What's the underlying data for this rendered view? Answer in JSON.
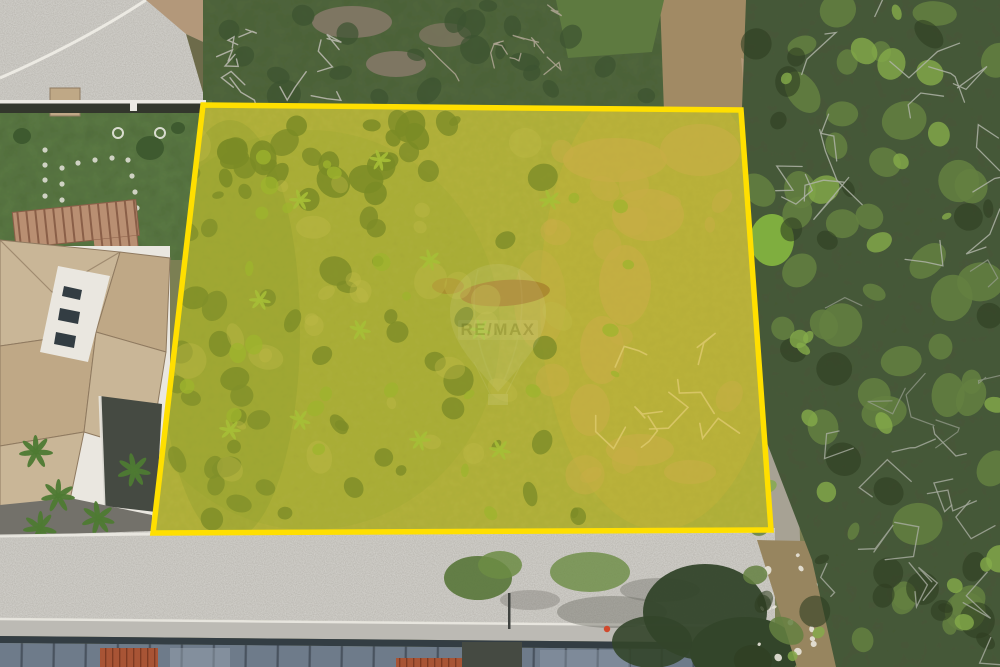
{
  "image": {
    "width": 1000,
    "height": 667,
    "alt": "Aerial drone photograph of a vacant land plot outlined and shaded in yellow, bordered by a house with tan tile roofs on the left, a walled garden and curved street at the top left, dense scrub forest on the right, and a cobblestone street with rooftops at the bottom"
  },
  "watermark": {
    "brand": "RE/MAX",
    "opacity": 0.16
  },
  "plot": {
    "points": "203,105 741,110 771,530 153,533",
    "fill": "#ffe400",
    "fill_opacity": 0.27,
    "stroke": "#ffdf00",
    "stroke_width": 5.5
  },
  "colors": {
    "base": "#7b7f53",
    "pavement": "#b6b3ac",
    "curb": "#eceae3",
    "dirtTan": "#b3987a",
    "dirtTan2": "#a18a64",
    "dirtGray": "#7e7662",
    "scrubBrown": "#6d6b4a",
    "lawn": "#5c7a44",
    "treeDark": "#3e5a2f",
    "pergola": "#b98f72",
    "pergolaSlat": "#8a5f48",
    "roofTan": "#c9b697",
    "roofTan2": "#bfa886",
    "roofEdge": "#8f7a60",
    "wallWhite": "#eae7e0",
    "windowDark": "#333d43",
    "shadowDark": "#454a42",
    "driveway": "#73716a",
    "wallDark": "#33372c",
    "brush": "#51663c",
    "grassTop": "#5e7a40",
    "forest": "#47573a",
    "bushBright": "#7fae3f",
    "plotGrass": "#96a052",
    "dirtCol": "#b29a5e",
    "brownDirt": "#8a6240",
    "shadeGreen": "#6f8f3f",
    "shadeGold": "#c2a44e",
    "leftBandGreen": "#5d7f3a",
    "canopyRoad": "#587539",
    "canopyRoad2": "#6c8c44",
    "canopyDarkRoad": "#33452a",
    "roadShadow": "#6f6e66",
    "sidewalk": "#bcbab4",
    "panelBase": "#6e7b8a",
    "panelLine": "#49535f",
    "panelLight": "#97a3b0",
    "tileRed": "#a85435",
    "tileRedDark": "#7e3a22",
    "pathGray": "#a7a294",
    "trailDirt": "#97855f",
    "personRed": "#d0492c",
    "poleDark": "#3f423f"
  },
  "texture": {
    "seed": 11,
    "specs": [
      {
        "type": "blob",
        "name": "plot-bush-dark",
        "layer": "interior",
        "region": [
          175,
          120,
          610,
          520
        ],
        "count": 46,
        "rmin": 5,
        "rmax": 15,
        "color": "#4d6c36",
        "opacity": 0.8
      },
      {
        "type": "blob",
        "name": "plot-bush-row-top",
        "layer": "interior",
        "region": [
          205,
          115,
          430,
          200
        ],
        "count": 18,
        "rmin": 8,
        "rmax": 18,
        "color": "#4a6a34",
        "opacity": 0.85
      },
      {
        "type": "blob",
        "name": "plot-bush-left",
        "layer": "interior",
        "region": [
          170,
          150,
          280,
          520
        ],
        "count": 20,
        "rmin": 8,
        "rmax": 16,
        "color": "#527139",
        "opacity": 0.8
      },
      {
        "type": "blob",
        "name": "plot-dry-grass",
        "layer": "interior",
        "region": [
          545,
          130,
          735,
          500
        ],
        "count": 16,
        "rmin": 8,
        "rmax": 20,
        "color": "#b49a5f",
        "opacity": 0.5
      },
      {
        "type": "blob",
        "name": "plot-grass-light",
        "layer": "interior",
        "region": [
          175,
          140,
          600,
          520
        ],
        "count": 30,
        "rmin": 6,
        "rmax": 18,
        "color": "#a8ab62",
        "opacity": 0.4
      },
      {
        "type": "blob",
        "name": "plot-bush-bright",
        "layer": "interior",
        "region": [
          185,
          130,
          630,
          515
        ],
        "count": 26,
        "rmin": 4,
        "rmax": 9,
        "color": "#7ba33e",
        "opacity": 0.75
      },
      {
        "type": "palm",
        "name": "plot-palm",
        "layer": "interior",
        "centers": [
          [
            300,
            200
          ],
          [
            260,
            300
          ],
          [
            360,
            330
          ],
          [
            300,
            420
          ],
          [
            430,
            260
          ],
          [
            480,
            330
          ],
          [
            420,
            440
          ],
          [
            500,
            450
          ],
          [
            380,
            160
          ],
          [
            550,
            200
          ],
          [
            230,
            430
          ]
        ],
        "petals": 6,
        "len": 11,
        "color": "#86b04a",
        "opacity": 0.9
      },
      {
        "type": "branch",
        "name": "fallen-tree-branch",
        "layer": "interior",
        "region": [
          600,
          345,
          715,
          445
        ],
        "count": 8,
        "len": 22,
        "color": "#cdbd8f",
        "width": 1.6,
        "opacity": 0.9
      },
      {
        "type": "blob",
        "name": "forest-canopy",
        "layer": "forest",
        "region": [
          752,
          0,
          1000,
          667
        ],
        "count": 46,
        "rmin": 9,
        "rmax": 24,
        "color": "#648041",
        "opacity": 0.85
      },
      {
        "type": "blob",
        "name": "forest-canopy-dark",
        "layer": "forest",
        "region": [
          752,
          0,
          1000,
          667
        ],
        "count": 28,
        "rmin": 7,
        "rmax": 18,
        "color": "#2e3d22",
        "opacity": 0.6
      },
      {
        "type": "blob",
        "name": "forest-canopy-bright",
        "layer": "forest",
        "region": [
          760,
          0,
          1000,
          667
        ],
        "count": 24,
        "rmin": 5,
        "rmax": 14,
        "color": "#85ab4a",
        "opacity": 0.8
      },
      {
        "type": "branch",
        "name": "forest-bare-branch",
        "layer": "forest",
        "region": [
          795,
          10,
          1000,
          250
        ],
        "count": 16,
        "len": 30,
        "color": "#aeb3a6",
        "width": 1.3,
        "opacity": 0.85
      },
      {
        "type": "branch",
        "name": "forest-bare-branch-low",
        "layer": "forest",
        "region": [
          820,
          420,
          1000,
          660
        ],
        "count": 14,
        "len": 30,
        "color": "#a9aea1",
        "width": 1.3,
        "opacity": 0.8
      },
      {
        "type": "branch",
        "name": "forest-bare-branch-mid",
        "layer": "forest",
        "region": [
          860,
          260,
          1000,
          430
        ],
        "count": 6,
        "len": 26,
        "color": "#9aa092",
        "width": 1.2,
        "opacity": 0.7
      },
      {
        "type": "blob",
        "name": "top-brush",
        "layer": "topstrip",
        "region": [
          210,
          5,
          650,
          100
        ],
        "count": 22,
        "rmin": 6,
        "rmax": 16,
        "color": "#3c5330",
        "opacity": 0.7
      },
      {
        "type": "branch",
        "name": "top-dead-branch",
        "layer": "topstrip",
        "region": [
          225,
          35,
          340,
          98
        ],
        "count": 10,
        "len": 18,
        "color": "#b8b7ad",
        "width": 1.4,
        "opacity": 0.9
      },
      {
        "type": "branch",
        "name": "top-dead-branch-right",
        "layer": "topstrip",
        "region": [
          455,
          8,
          565,
          92
        ],
        "count": 8,
        "len": 16,
        "color": "#b0a795",
        "width": 1.3,
        "opacity": 0.85
      },
      {
        "type": "blob",
        "name": "trail-debris",
        "layer": "trail",
        "region": [
          758,
          545,
          842,
          660
        ],
        "count": 16,
        "rmin": 1.5,
        "rmax": 4,
        "color": "#e8e4da",
        "opacity": 0.9
      },
      {
        "type": "palm",
        "name": "house-palm",
        "layer": "house",
        "centers": [
          [
            58,
            496
          ],
          [
            98,
            518
          ],
          [
            134,
            470
          ],
          [
            36,
            452
          ],
          [
            40,
            528
          ]
        ],
        "petals": 7,
        "len": 17,
        "color": "#4e7a33",
        "opacity": 0.95
      },
      {
        "type": "dots",
        "name": "stepping-stone",
        "layer": "garden",
        "pts": [
          [
            45,
            150
          ],
          [
            45,
            165
          ],
          [
            45,
            180
          ],
          [
            45,
            196
          ],
          [
            45,
            212
          ],
          [
            45,
            228
          ],
          [
            45,
            244
          ],
          [
            62,
            168
          ],
          [
            78,
            163
          ],
          [
            95,
            160
          ],
          [
            112,
            158
          ],
          [
            128,
            160
          ],
          [
            132,
            176
          ],
          [
            135,
            192
          ],
          [
            137,
            208
          ],
          [
            133,
            224
          ],
          [
            118,
            230
          ],
          [
            102,
            234
          ],
          [
            85,
            236
          ],
          [
            68,
            232
          ],
          [
            64,
            216
          ],
          [
            62,
            200
          ],
          [
            62,
            184
          ]
        ],
        "r": 2.6,
        "color": "#ddddd2",
        "opacity": 0.9
      },
      {
        "type": "ring",
        "name": "garden-ring",
        "layer": "garden",
        "pts": [
          [
            118,
            133
          ],
          [
            160,
            133
          ]
        ],
        "r": 5,
        "color": "#e8e8df",
        "width": 2,
        "opacity": 0.9
      }
    ]
  }
}
